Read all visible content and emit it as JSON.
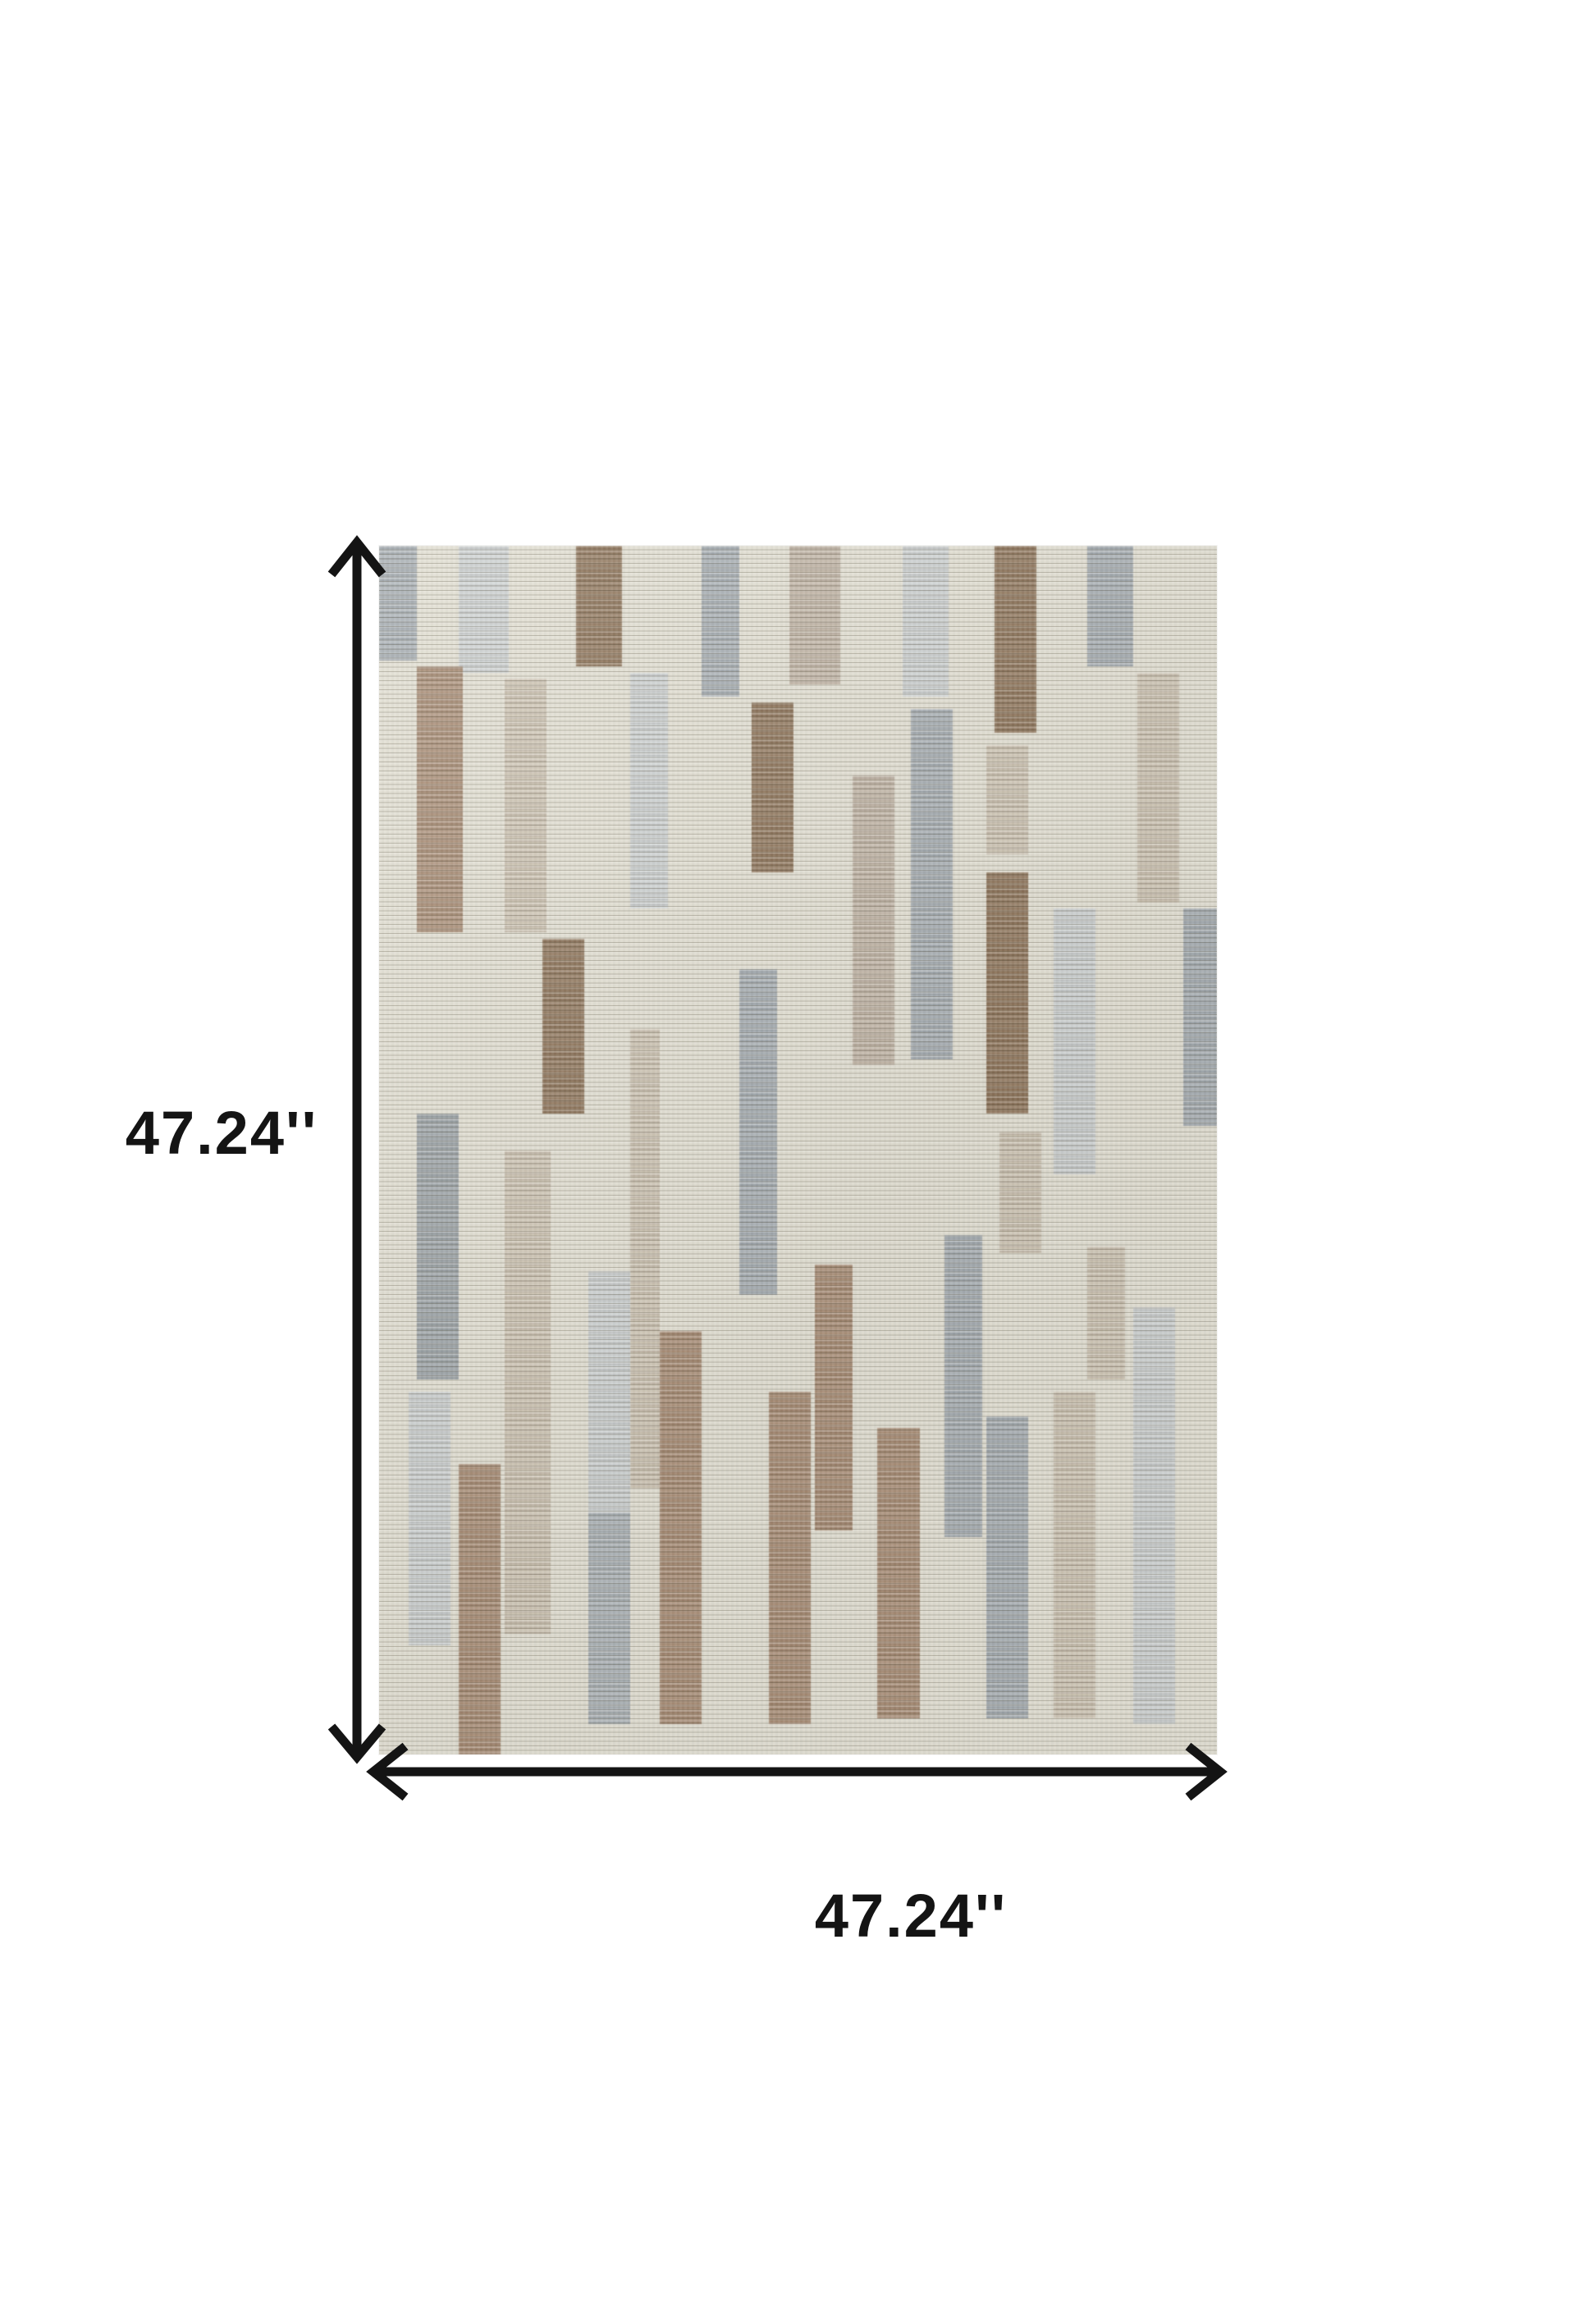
{
  "page": {
    "background": "#ffffff"
  },
  "dimensions": {
    "height_label": "47.24''",
    "width_label": "47.24''",
    "arrow_color": "#141414"
  },
  "rug": {
    "description": "modern-abstract-striped-rug",
    "background": "#e1ded2",
    "palette": {
      "g1": "#cbcfcf",
      "g2": "#a4abb0",
      "g2l": "#aab1b5",
      "g2m": "#9aa1a5",
      "tn": "#beb2a2",
      "be": "#ccc2b1",
      "br": "#8c7257",
      "br2": "#a68a72"
    },
    "blocks": [
      {
        "x": 0,
        "y": 0,
        "w": 4.5,
        "h": 9.5,
        "c": "g2"
      },
      {
        "x": 9.5,
        "y": 0,
        "w": 6,
        "h": 10.5,
        "c": "g1"
      },
      {
        "x": 23.5,
        "y": 0,
        "w": 5.5,
        "h": 10,
        "c": "br"
      },
      {
        "x": 38.5,
        "y": 0,
        "w": 4.5,
        "h": 12.5,
        "c": "g2"
      },
      {
        "x": 49,
        "y": 0,
        "w": 6,
        "h": 11.5,
        "c": "tn"
      },
      {
        "x": 62.5,
        "y": 0,
        "w": 5.5,
        "h": 12.5,
        "c": "g1"
      },
      {
        "x": 73.5,
        "y": 0,
        "w": 5,
        "h": 15.5,
        "c": "br"
      },
      {
        "x": 84.5,
        "y": 0,
        "w": 5.5,
        "h": 10,
        "c": "g2"
      },
      {
        "x": 90.5,
        "y": 10.5,
        "w": 5,
        "h": 19,
        "c": "be"
      },
      {
        "x": 4.5,
        "y": 10,
        "w": 5.5,
        "h": 22,
        "c": "br2"
      },
      {
        "x": 15,
        "y": 11,
        "w": 5,
        "h": 21,
        "c": "be"
      },
      {
        "x": 30,
        "y": 10.5,
        "w": 4.5,
        "h": 19.5,
        "c": "g1"
      },
      {
        "x": 44.5,
        "y": 13,
        "w": 5,
        "h": 14,
        "c": "br"
      },
      {
        "x": 56.5,
        "y": 19,
        "w": 5,
        "h": 24,
        "c": "tn"
      },
      {
        "x": 63.5,
        "y": 13.5,
        "w": 5,
        "h": 29,
        "c": "g2"
      },
      {
        "x": 72.5,
        "y": 16.5,
        "w": 5,
        "h": 9,
        "c": "be"
      },
      {
        "x": 72.5,
        "y": 27,
        "w": 5,
        "h": 20,
        "c": "br"
      },
      {
        "x": 80.5,
        "y": 30,
        "w": 5,
        "h": 22,
        "c": "g1"
      },
      {
        "x": 96,
        "y": 30,
        "w": 4,
        "h": 18,
        "c": "g2"
      },
      {
        "x": 19.5,
        "y": 32.5,
        "w": 5,
        "h": 14.5,
        "c": "br"
      },
      {
        "x": 30,
        "y": 40,
        "w": 3.5,
        "h": 38,
        "c": "be"
      },
      {
        "x": 43,
        "y": 35,
        "w": 4.5,
        "h": 27,
        "c": "g2"
      },
      {
        "x": 4.5,
        "y": 47,
        "w": 5,
        "h": 22,
        "c": "g2m"
      },
      {
        "x": 15,
        "y": 50,
        "w": 5.5,
        "h": 40,
        "c": "be"
      },
      {
        "x": 52,
        "y": 59.5,
        "w": 4.5,
        "h": 22,
        "c": "br2"
      },
      {
        "x": 67.5,
        "y": 57,
        "w": 4.5,
        "h": 25,
        "c": "g2"
      },
      {
        "x": 74,
        "y": 48.5,
        "w": 5,
        "h": 10,
        "c": "be"
      },
      {
        "x": 84.5,
        "y": 58,
        "w": 4.5,
        "h": 11,
        "c": "be"
      },
      {
        "x": 3.5,
        "y": 70,
        "w": 5,
        "h": 21,
        "c": "g1"
      },
      {
        "x": 9.5,
        "y": 76,
        "w": 5,
        "h": 24,
        "c": "br2"
      },
      {
        "x": 25,
        "y": 60,
        "w": 5,
        "h": 20,
        "c": "g1"
      },
      {
        "x": 25,
        "y": 80,
        "w": 5,
        "h": 17.5,
        "c": "g2l"
      },
      {
        "x": 33.5,
        "y": 65,
        "w": 5,
        "h": 32.5,
        "c": "br2"
      },
      {
        "x": 46.5,
        "y": 70,
        "w": 5,
        "h": 27.5,
        "c": "br2"
      },
      {
        "x": 59.5,
        "y": 73,
        "w": 5,
        "h": 24,
        "c": "br2"
      },
      {
        "x": 72.5,
        "y": 72,
        "w": 5,
        "h": 25,
        "c": "g2"
      },
      {
        "x": 80.5,
        "y": 70,
        "w": 5,
        "h": 27,
        "c": "be"
      },
      {
        "x": 90,
        "y": 63,
        "w": 5,
        "h": 34.5,
        "c": "g1"
      }
    ]
  }
}
